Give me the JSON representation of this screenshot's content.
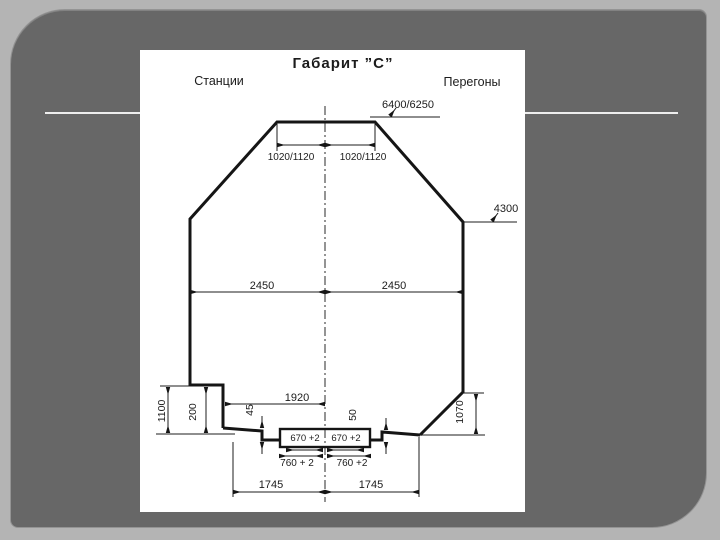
{
  "theme": {
    "page_bg": "#b4b4b4",
    "slide_bg": "#676767",
    "panel_bg": "#ffffff",
    "drawing_line_color": "#1c1c1c",
    "deco_line_color": "#eeeeee"
  },
  "diagram": {
    "title": "Габарит ”С”",
    "left_heading": "Станции",
    "right_heading": "Перегоны",
    "dims": {
      "top_width": "6400/6250",
      "top_left_half": "1020/1120",
      "top_right_half": "1020/1120",
      "height_right": "4300",
      "mid_left_half": "2450",
      "mid_right_half": "2450",
      "platform_offset": "1920",
      "platform_height": "1100",
      "step_height": "200",
      "left_gap": "45",
      "right_gap": "50",
      "right_height": "1070",
      "rail_inner_left": "670 +2",
      "rail_inner_right": "670 +2",
      "rail_outer_left": "760 + 2",
      "rail_outer_right": "760 +2",
      "bottom_left_half": "1745",
      "bottom_right_half": "1745"
    }
  }
}
